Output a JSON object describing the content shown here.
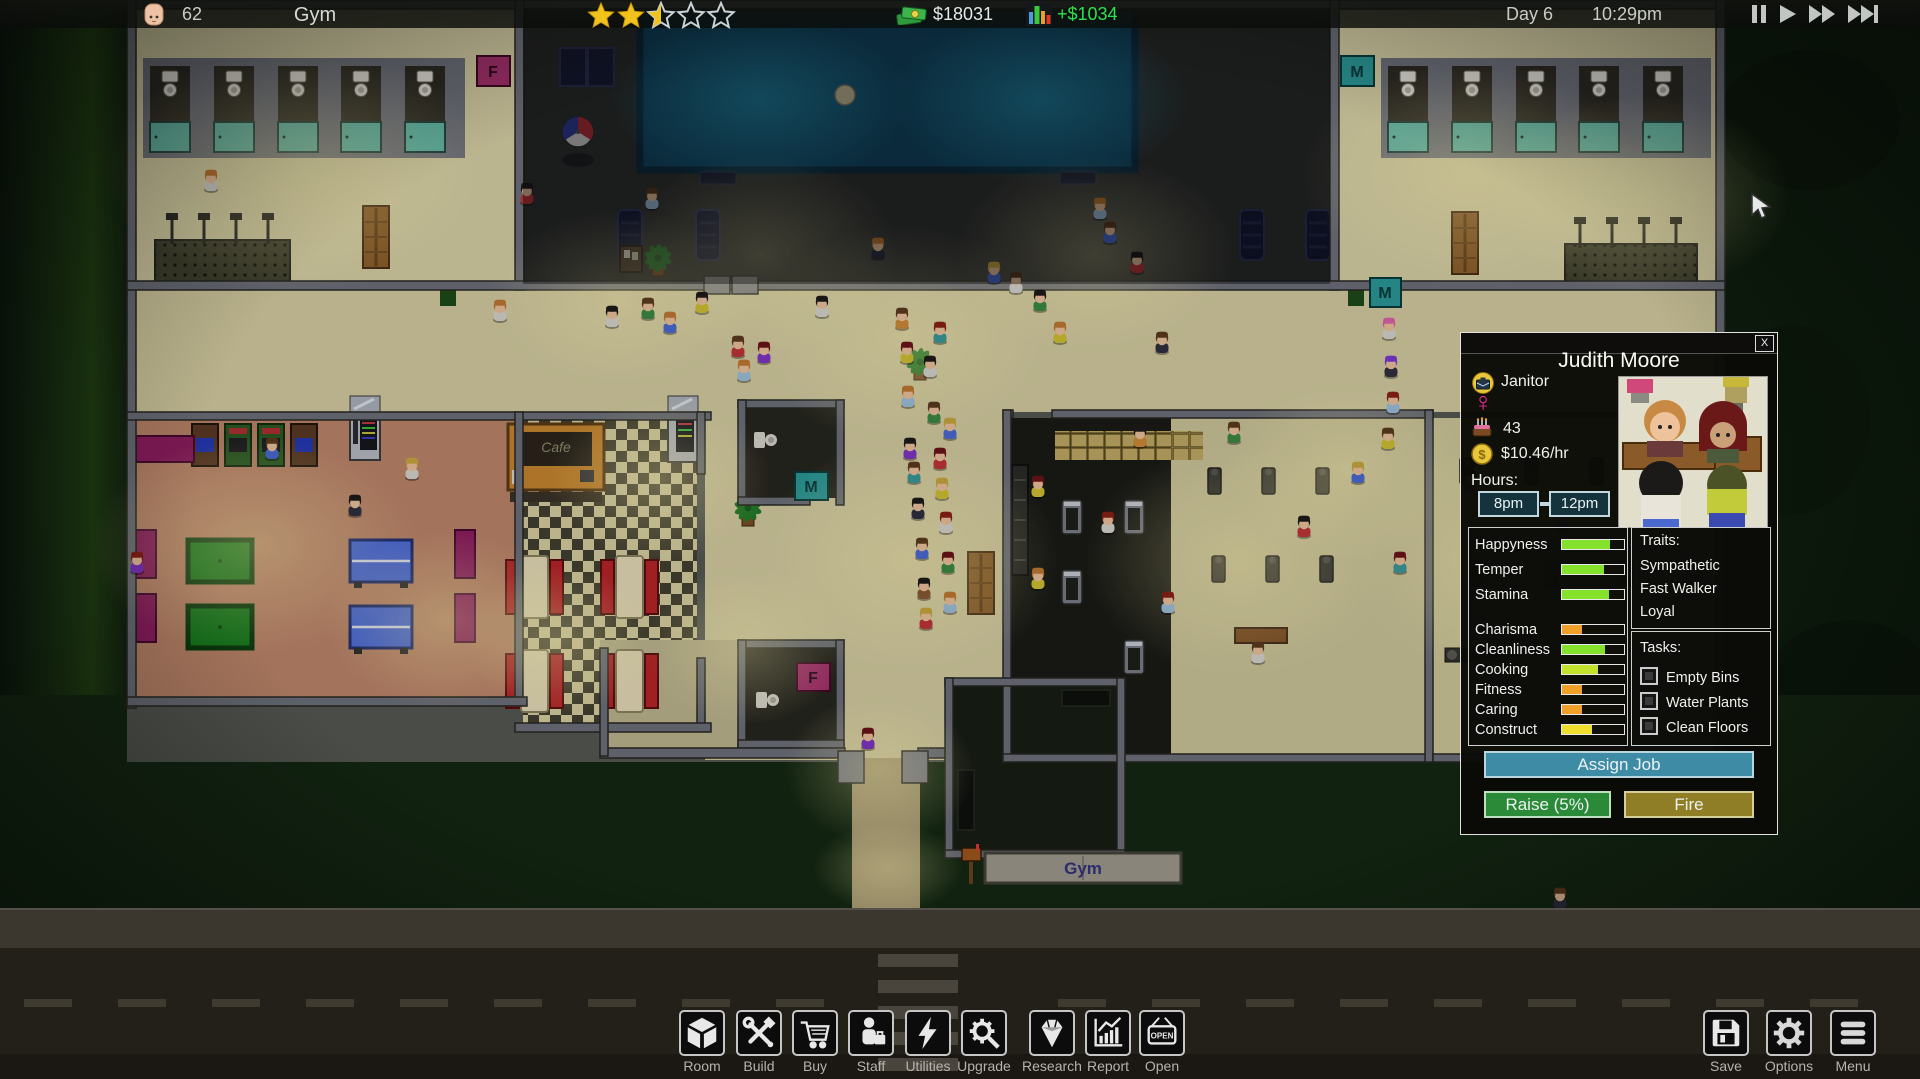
{
  "topbar": {
    "visitors": "62",
    "title": "Gym",
    "rating": 2.5,
    "rating_max": 5,
    "money": "$18031",
    "income": "+$1034",
    "day": "Day 6",
    "time": "10:29pm"
  },
  "panel": {
    "close": "X",
    "name": "Judith Moore",
    "job": "Janitor",
    "gender_symbol": "♀",
    "age": "43",
    "wage": "$10.46/hr",
    "hours_label": "Hours:",
    "shift_start": "8pm",
    "shift_end": "12pm",
    "stats": [
      {
        "label": "Happyness",
        "value": 78,
        "color": "#84e22c"
      },
      {
        "label": "Temper",
        "value": 68,
        "color": "#84e22c"
      },
      {
        "label": "Stamina",
        "value": 75,
        "color": "#84e22c"
      },
      {
        "label": "Charisma",
        "value": 33,
        "color": "#f0a028"
      },
      {
        "label": "Cleanliness",
        "value": 70,
        "color": "#84e22c"
      },
      {
        "label": "Cooking",
        "value": 58,
        "color": "#c2e22c"
      },
      {
        "label": "Fitness",
        "value": 33,
        "color": "#f0a028"
      },
      {
        "label": "Caring",
        "value": 32,
        "color": "#f0a028"
      },
      {
        "label": "Construct",
        "value": 48,
        "color": "#f0de2c"
      }
    ],
    "traits_label": "Traits:",
    "traits": [
      "Sympathetic",
      "Fast Walker",
      "Loyal"
    ],
    "tasks_label": "Tasks:",
    "tasks": [
      "Empty Bins",
      "Water Plants",
      "Clean Floors"
    ],
    "assign_job": "Assign Job",
    "raise": "Raise (5%)",
    "fire": "Fire"
  },
  "toolbar": {
    "items": [
      {
        "label": "Room"
      },
      {
        "label": "Build"
      },
      {
        "label": "Buy"
      },
      {
        "label": "Staff"
      },
      {
        "label": "Utilities"
      },
      {
        "label": "Upgrade"
      },
      {
        "label": "Research"
      },
      {
        "label": "Report"
      },
      {
        "label": "Open",
        "icon_text": "OPEN"
      }
    ],
    "right": [
      {
        "label": "Save"
      },
      {
        "label": "Options"
      },
      {
        "label": "Menu"
      }
    ]
  },
  "map": {
    "signs": {
      "cafe": "Cafe",
      "gym": "Gym",
      "female": "F",
      "male": "M"
    }
  }
}
